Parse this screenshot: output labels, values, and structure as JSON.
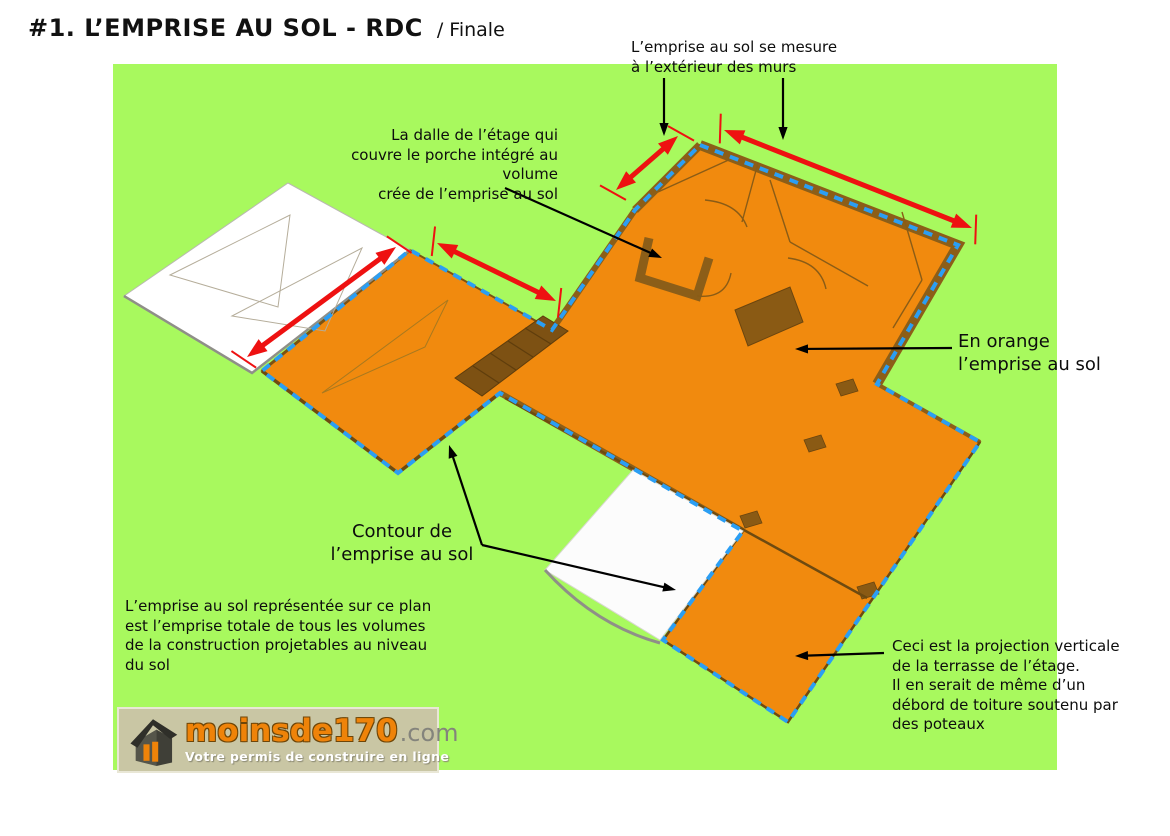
{
  "title": {
    "main": "#1. L’EMPRISE AU SOL - RDC",
    "suffix": "/ Finale"
  },
  "annotations": {
    "measure": "L’emprise au sol se mesure\nà l’extérieur des murs",
    "dalle": "La dalle de l’étage qui\ncouvre le porche intégré au volume\ncrée de l’emprise au sol",
    "orange": "En orange\nl’emprise au sol",
    "contour": "Contour de\nl’emprise au sol",
    "bottom_left": "L’emprise au sol représentée sur ce plan\nest l’emprise totale de tous les volumes\nde la construction projetables au niveau\ndu sol",
    "terrace": "Ceci est la projection verticale\nde la terrasse de l’étage.\nIl en serait de même d’un\ndébord de toiture soutenu par\ndes poteaux"
  },
  "logo": {
    "brand": "moinsde170",
    "tld": ".com",
    "tagline": "Votre permis de construire en ligne"
  },
  "colors": {
    "background_green": "#a8f95e",
    "footprint_orange": "#f18a0e",
    "contour_blue": "#2b9ef3",
    "dimension_red": "#ee1111",
    "wall_brown": "#8c5e18",
    "logo_background": "#c9c6a4",
    "logo_orange": "#ef8309"
  }
}
